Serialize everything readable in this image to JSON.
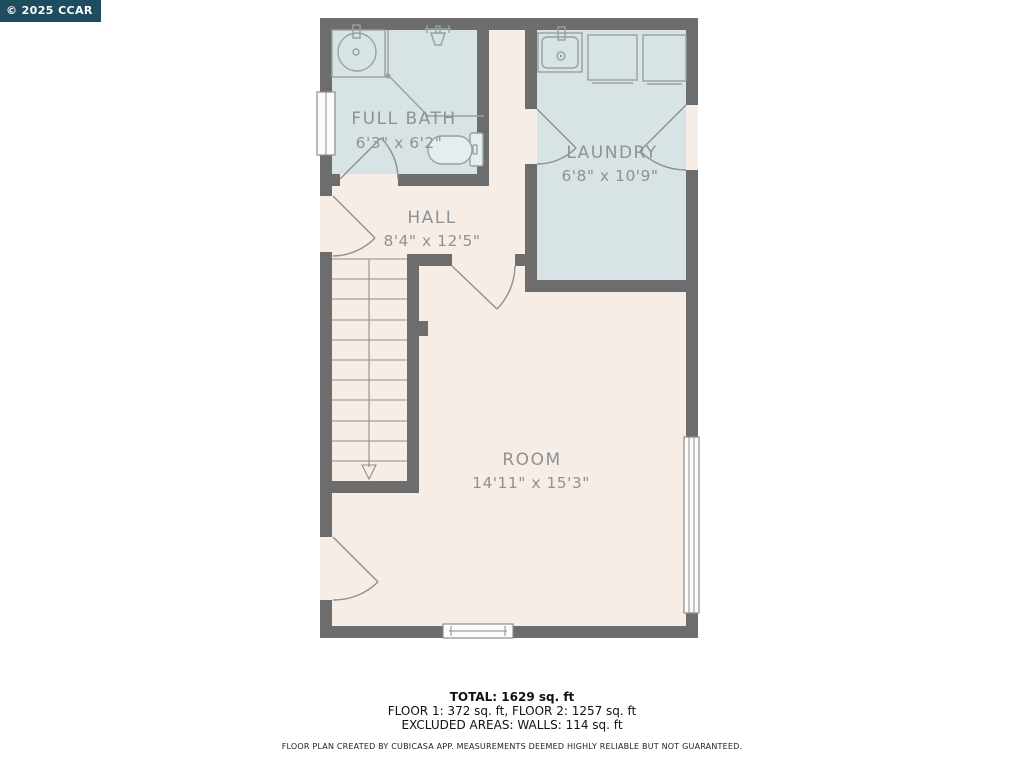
{
  "watermark": {
    "text": "© 2025 CCAR",
    "bg_color": "#1e4d5f",
    "text_color": "#ffffff"
  },
  "rooms": [
    {
      "id": "full-bath",
      "name": "FULL BATH",
      "dimensions": "6'3\" x 6'2\""
    },
    {
      "id": "laundry",
      "name": "LAUNDRY",
      "dimensions": "6'8\" x 10'9\""
    },
    {
      "id": "hall",
      "name": "HALL",
      "dimensions": "8'4\" x 12'5\""
    },
    {
      "id": "room",
      "name": "ROOM",
      "dimensions": "14'11\" x 15'3\""
    }
  ],
  "summary": {
    "total": "TOTAL: 1629 sq. ft",
    "floors": "FLOOR 1: 372 sq. ft, FLOOR 2: 1257 sq. ft",
    "excluded": "EXCLUDED AREAS: WALLS: 114 sq. ft",
    "disclaimer": "FLOOR PLAN CREATED BY CUBICASA APP. MEASUREMENTS DEEMED HIGHLY RELIABLE BUT NOT GUARANTEED."
  },
  "colors": {
    "wall": "#6d6d6d",
    "wet_room_floor": "#d7e3e4",
    "dry_room_floor": "#f7ede7",
    "label_text": "#8d9294"
  },
  "icons": [
    "bathroom-sink-icon",
    "shower-icon",
    "toilet-icon",
    "laundry-sink-icon",
    "washer-icon",
    "dryer-icon",
    "stairs-down-arrow-icon"
  ]
}
